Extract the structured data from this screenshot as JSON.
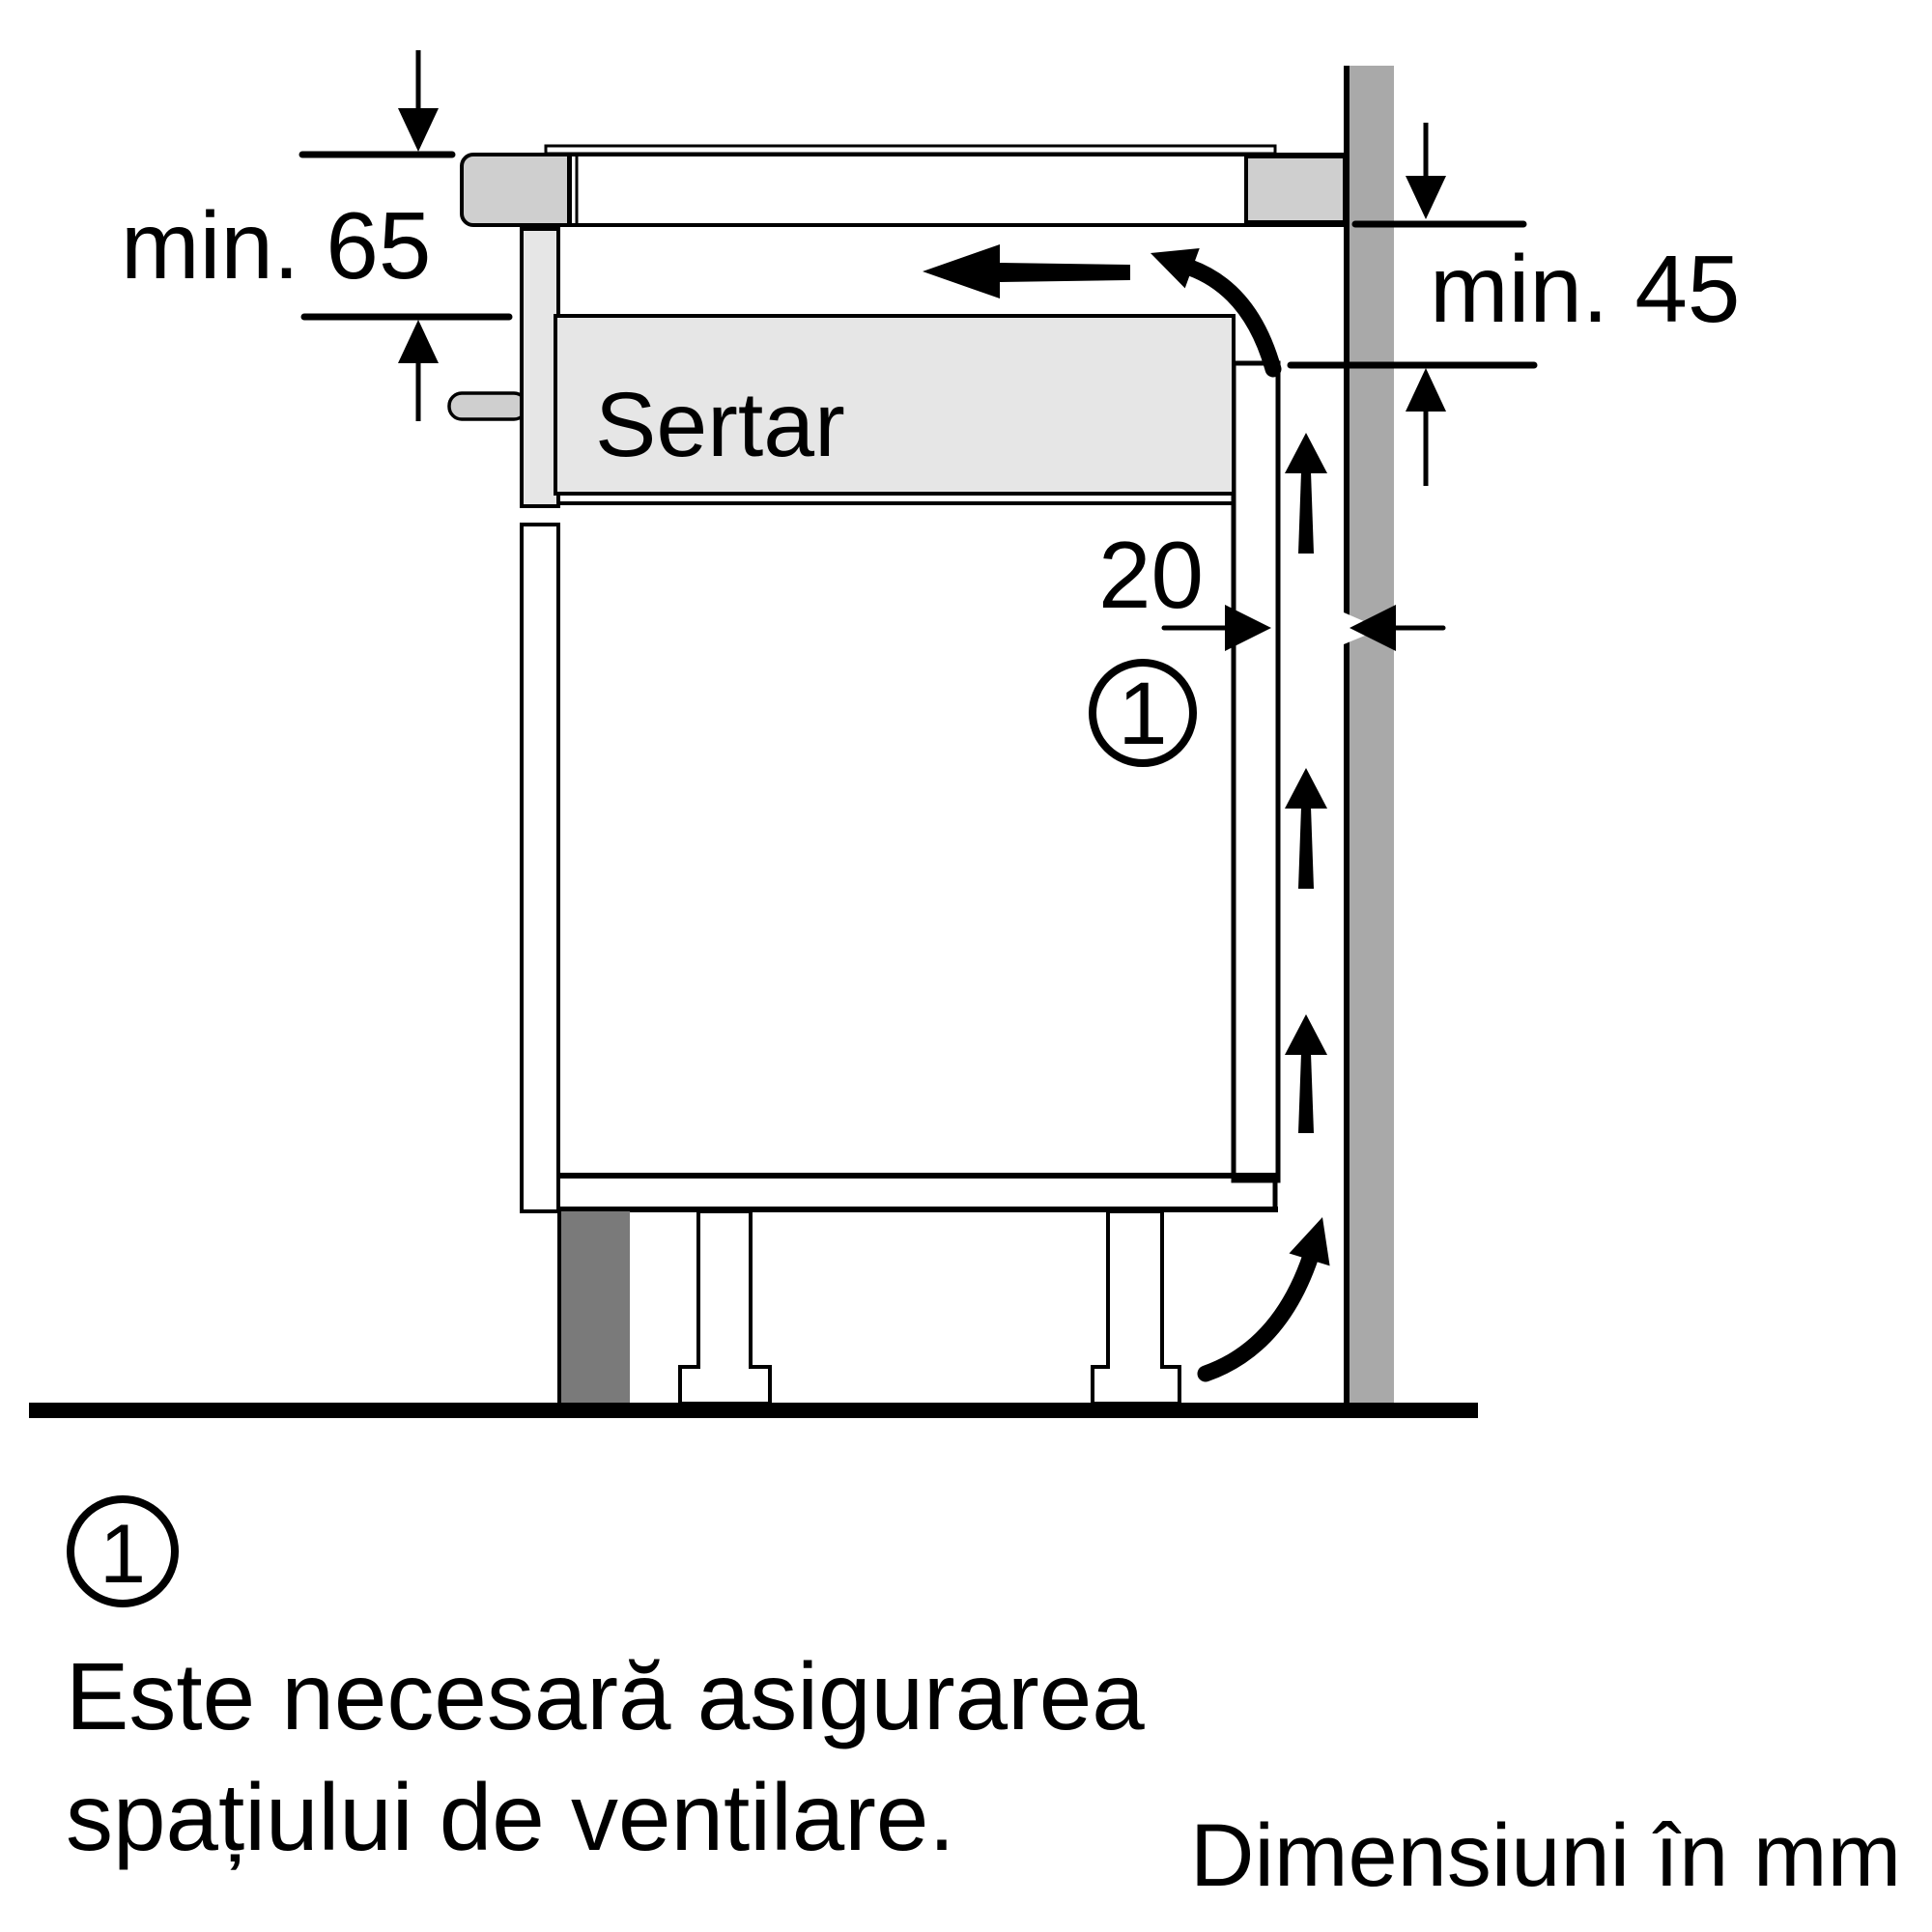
{
  "title": "Hob installation ventilation diagram",
  "dimensions": {
    "top_left": "min. 65",
    "right": "min. 45",
    "rear_gap": "20"
  },
  "drawer_label": "Sertar",
  "callout_marker": "1",
  "note": {
    "marker": "1",
    "line1": "Este necesară asigurarea",
    "line2": "spațiului de ventilare."
  },
  "footer_units": "Dimensiuni în mm",
  "icons": {
    "down-arrow-icon": "filled triangle arrow pointing down",
    "up-arrow-icon": "filled triangle arrow pointing up",
    "left-arrow-icon": "filled triangle arrow pointing left",
    "right-arrow-icon": "filled triangle arrow pointing right",
    "airflow-up-arrow-icon": "tapered vertical airflow arrow",
    "curved-arrow-icon": "curved airflow arrow"
  },
  "colors": {
    "background": "#ffffff",
    "outline": "#000000",
    "wall": "#a9a9a9",
    "panel_light": "#cfcfcf",
    "drawer_fill": "#e6e6e6",
    "plinth_dark": "#7a7a7a"
  }
}
